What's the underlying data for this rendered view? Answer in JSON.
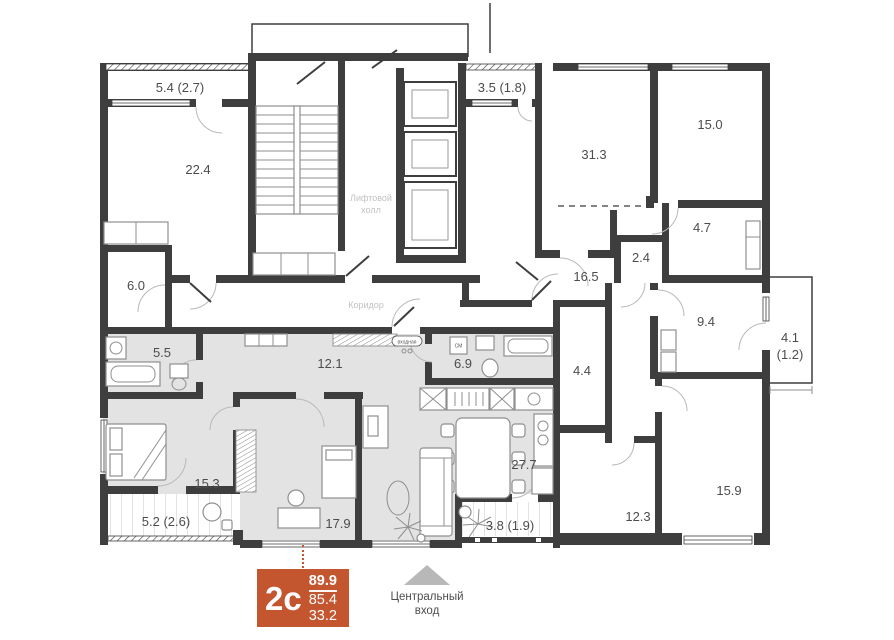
{
  "plan": {
    "common_rooms": {
      "balcony_5_4": {
        "label": "5.4 (2.7)"
      },
      "room_22_4": {
        "label": "22.4"
      },
      "room_6_0": {
        "label": "6.0"
      },
      "balcony_3_5": {
        "label": "3.5 (1.8)"
      },
      "room_31_3": {
        "label": "31.3"
      },
      "room_15_0": {
        "label": "15.0"
      },
      "room_4_7": {
        "label": "4.7"
      },
      "room_2_4": {
        "label": "2.4"
      },
      "corridor_16_5": {
        "label": "16.5"
      },
      "room_9_4": {
        "label": "9.4"
      },
      "balcony_4_1": {
        "label": "4.1",
        "label2": "(1.2)"
      },
      "room_15_9": {
        "label": "15.9"
      },
      "room_12_3": {
        "label": "12.3"
      },
      "room_4_4": {
        "label": "4.4"
      }
    },
    "apartment": {
      "bathroom_5_5": {
        "label": "5.5"
      },
      "hallway_12_1": {
        "label": "12.1"
      },
      "bathroom_6_9": {
        "label": "6.9"
      },
      "living_27_7": {
        "label": "27.7"
      },
      "bedroom_15_3": {
        "label": "15.3"
      },
      "bedroom_17_9": {
        "label": "17.9"
      },
      "balcony_5_2": {
        "label": "5.2 (2.6)"
      },
      "balcony_3_8": {
        "label": "3.8 (1.9)"
      },
      "entry_tag": "входная",
      "washer_tag": "СМ"
    },
    "area_labels": {
      "elevator_hall_line1": "Лифтовой",
      "elevator_hall_line2": "холл",
      "corridor": "Коридор"
    },
    "unit_card": {
      "type": "2с",
      "total_area": "89.9",
      "area": "85.4",
      "living_area": "33.2"
    },
    "entrance": {
      "line1": "Центральный",
      "line2": "вход"
    }
  },
  "colors": {
    "accent": "#c3562f",
    "wall": "#3e3e3e",
    "unit_fill": "#e3e3e3",
    "muted_label": "#c2c2c2",
    "label_text": "#4d4d4d",
    "furniture_stroke": "#8f8f8f",
    "entrance_arrow": "#b8b8b8"
  }
}
